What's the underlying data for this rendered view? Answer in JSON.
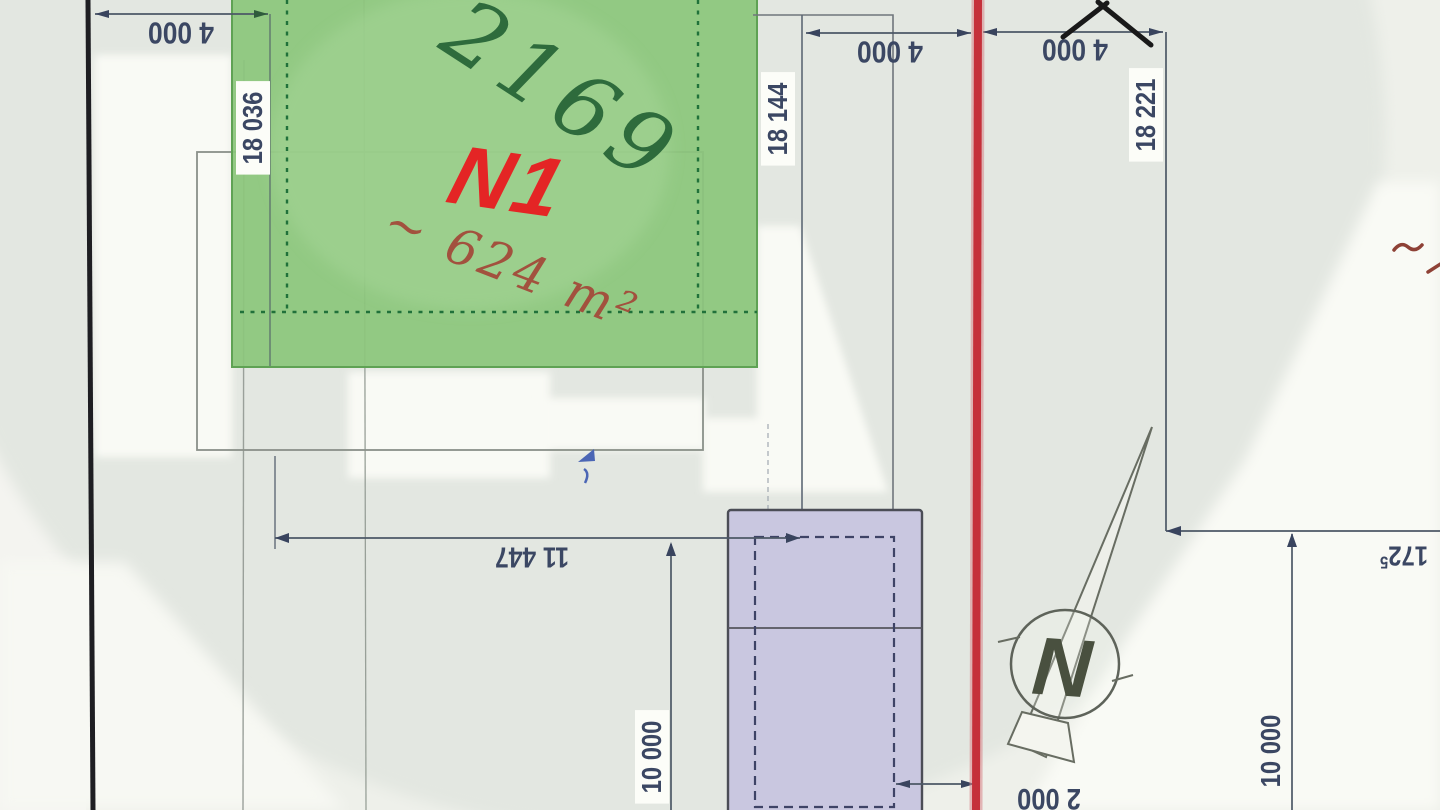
{
  "document": {
    "type": "scanned site plan"
  },
  "parcel": {
    "number_handwritten": "2169",
    "label": "N1",
    "area": "~ 624 m²"
  },
  "compass": {
    "label": "N"
  },
  "marks": {
    "top_right_stroke": "7",
    "right_edge_squiggle": "~"
  },
  "dimensions": {
    "top_left": "4 000",
    "top_middle": "4 000",
    "top_right": "4 000",
    "left_depth": "18 036",
    "middle_depth": "18 144",
    "right_depth": "18 221",
    "plot_width": "11 447",
    "building_length_left": "10 000",
    "building_length_right": "10 000",
    "building_offset": "2 000",
    "right_boundary": "172",
    "right_boundary_sup": "5"
  },
  "colors": {
    "parcel_green": "#8cc67c",
    "parcel_green_border": "#5fa254",
    "dashed_setback_green": "#20713a",
    "boundary_red": "#c5303a",
    "boundary_black": "#1e1e22",
    "building_purple": "#c9c7e0",
    "dimension_text": "#3b4763",
    "label_red": "#e42525",
    "area_red": "#a2513e",
    "handwriting_green": "#2e6b3c"
  }
}
